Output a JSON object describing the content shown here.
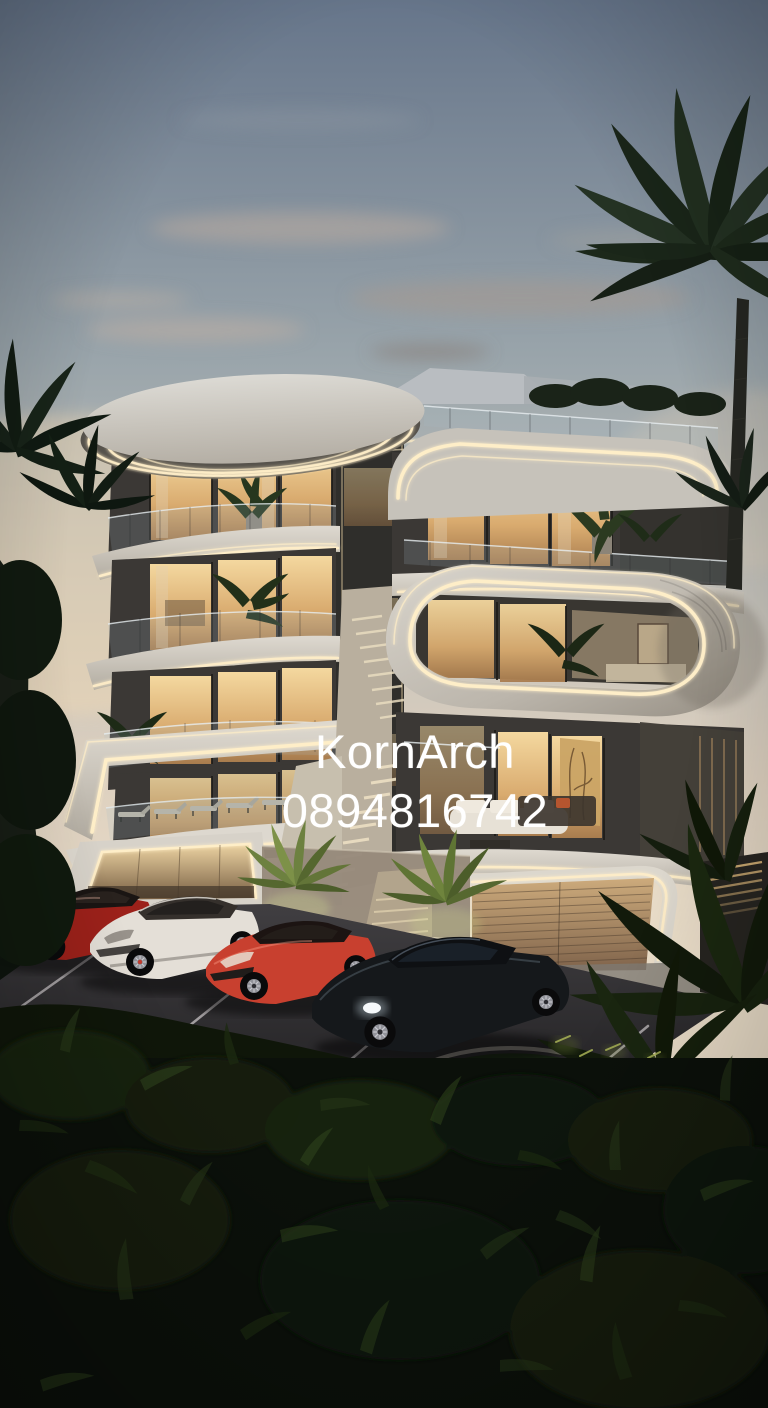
{
  "watermark": {
    "line1": "KornArch",
    "line2": "0894816742",
    "color": "#ffffff"
  },
  "palette": {
    "sky_top": "#66758a",
    "sky_mid": "#b3b7b6",
    "sky_horizon": "#ecddc6",
    "sunset_glow": "#f2d9b2",
    "led": "#ffeec8",
    "concrete": "#d6d2c9",
    "dark_wall": "#3b3835",
    "window_glow": "#eccd96",
    "foliage": "#15200f",
    "asphalt": "#2c2b2e",
    "car_red_dark": "#9c211a",
    "car_red_bright": "#c8402f",
    "car_white": "#e4dfd7",
    "car_black": "#15181b"
  }
}
